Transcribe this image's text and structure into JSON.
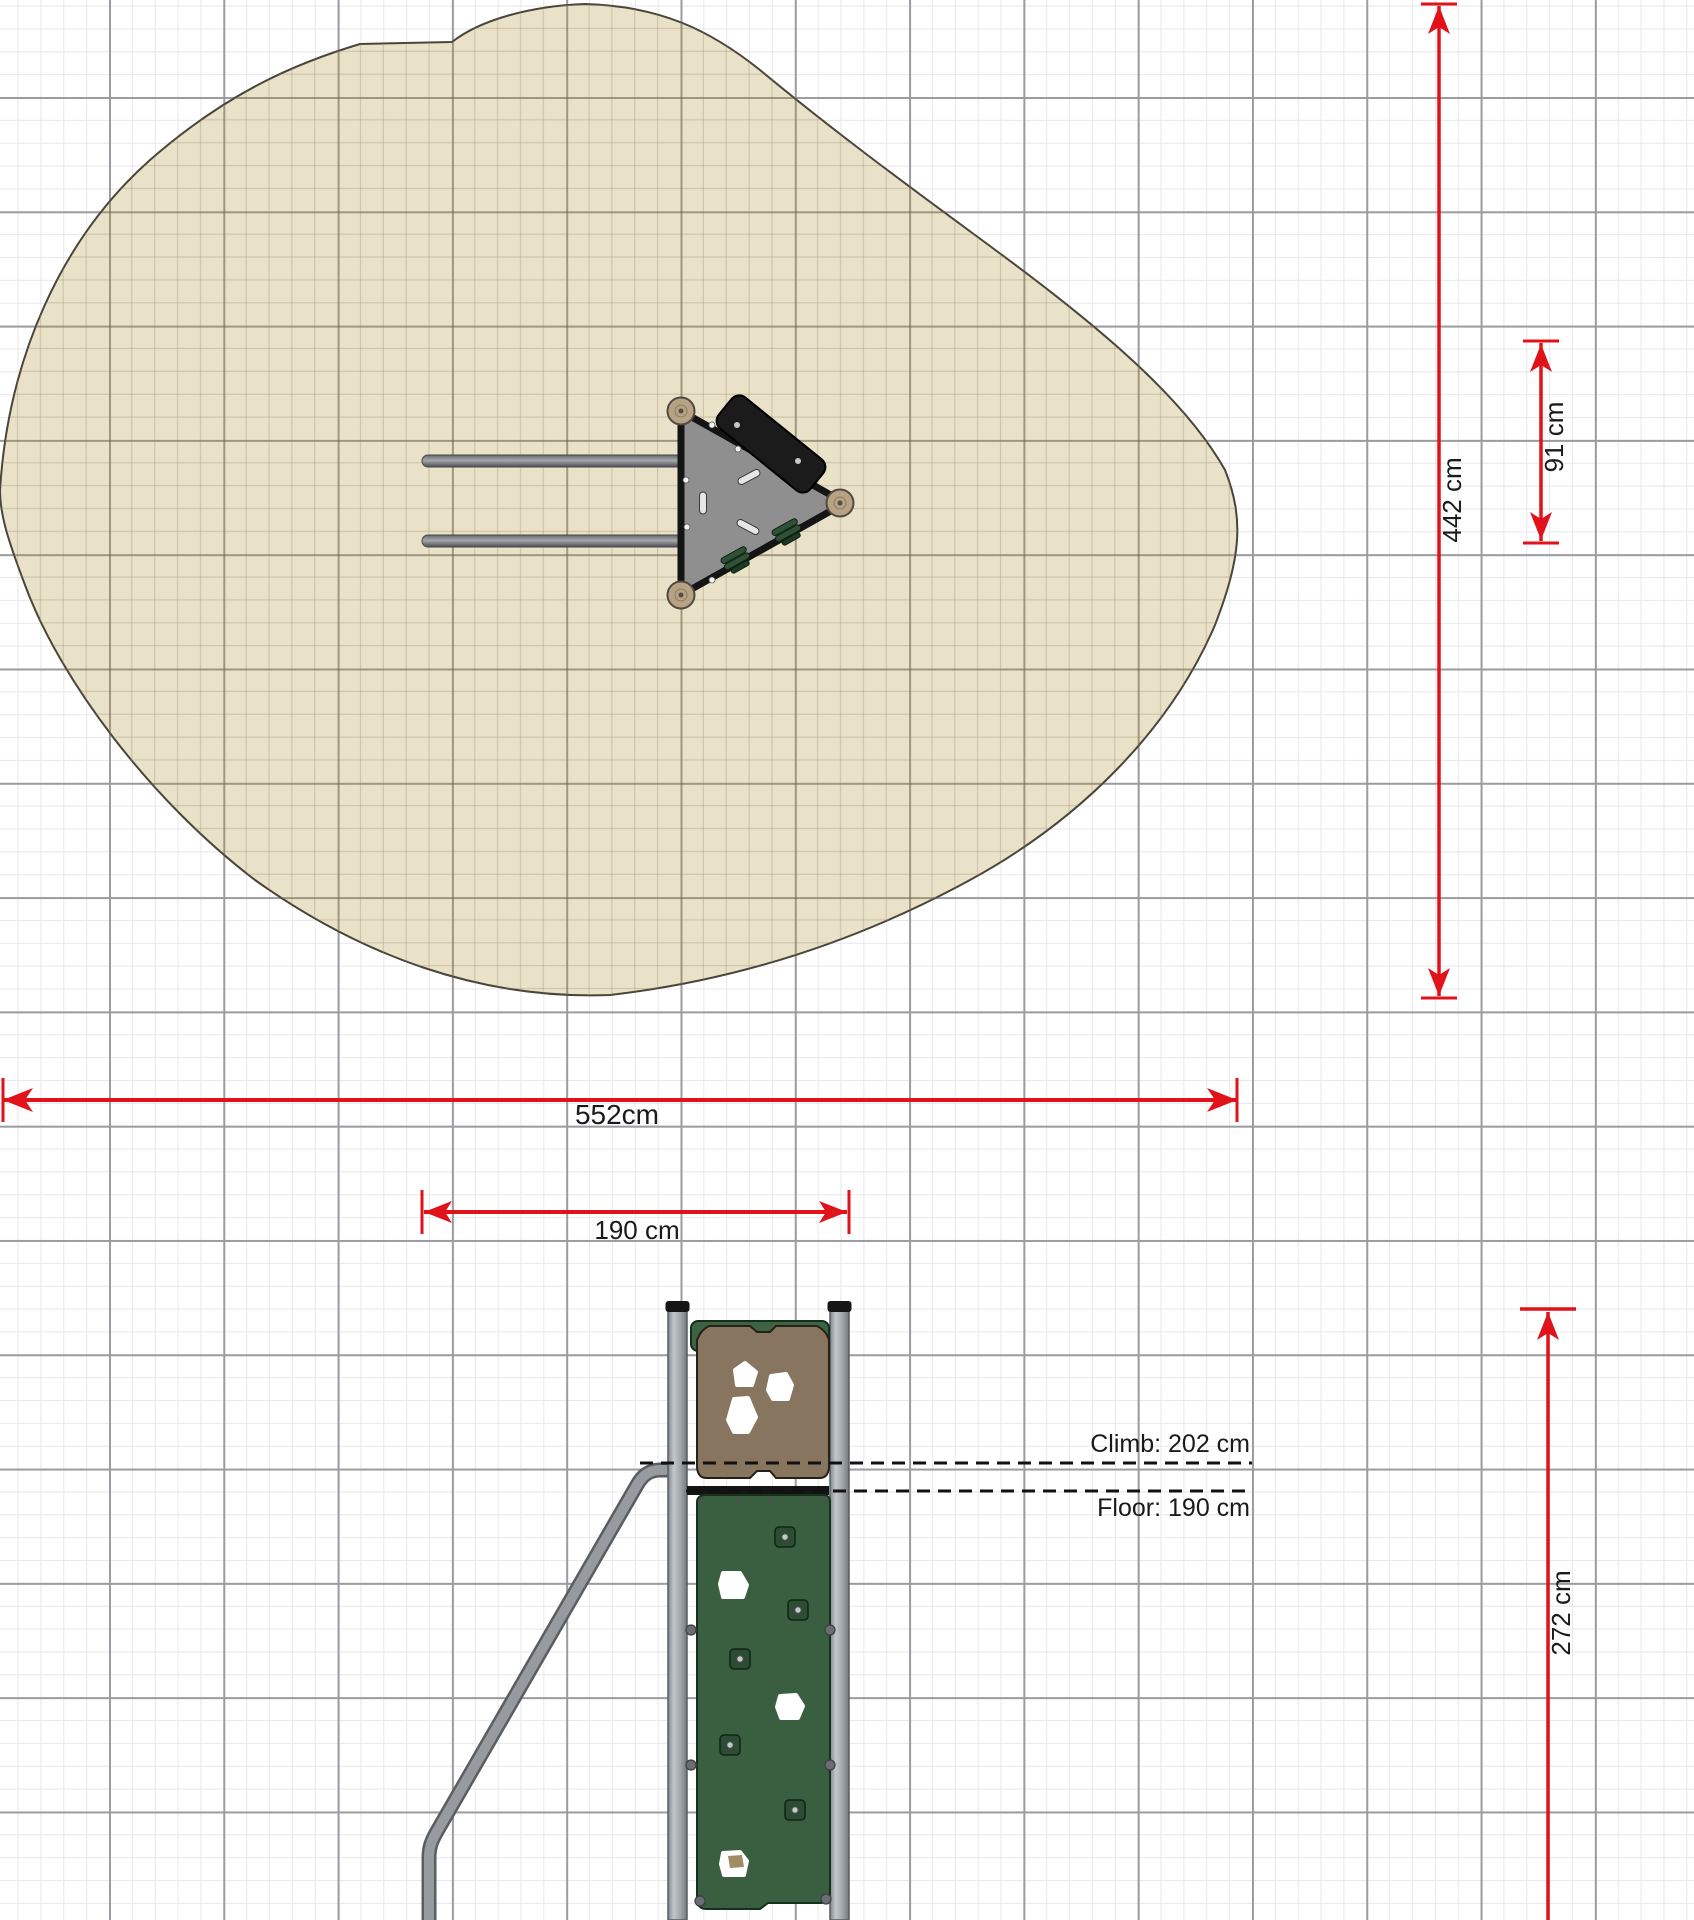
{
  "page": {
    "title": "playground-equipment-technical-drawing",
    "grid_minor_color": "#e7e7ed",
    "grid_major_color": "#9b9ba1",
    "background": "#ffffff"
  },
  "safety_zone": {
    "description": "safety-surfacing-area-plan",
    "fill": "#e9e1c8",
    "outline": "#4a4539"
  },
  "plan_view": {
    "platform_fill": "#8f8f8f",
    "platform_outline": "#141414",
    "climb_panel_fill": "#1b1b1b",
    "post_fill": "#b7a284",
    "bar_fill": "#7d8184"
  },
  "elevation_view": {
    "post_fill": "#a9aeb3",
    "brown_panel_fill": "#87755f",
    "green_panel_fill": "#3a5e40",
    "bracket_fill": "#3c6443",
    "hold_fill": "#2c4c33",
    "handrail_fill": "#979ba0"
  },
  "dimensions": {
    "accent_color": "#e11219",
    "safety_width": {
      "label": "552cm"
    },
    "equipment_width": {
      "label": "190 cm"
    },
    "safety_height": {
      "label": "442 cm"
    },
    "equipment_depth": {
      "label": "91 cm"
    },
    "total_height": {
      "label": "272 cm"
    },
    "climb_height": {
      "label": "Climb: 202 cm"
    },
    "floor_height": {
      "label": "Floor: 190 cm"
    }
  }
}
